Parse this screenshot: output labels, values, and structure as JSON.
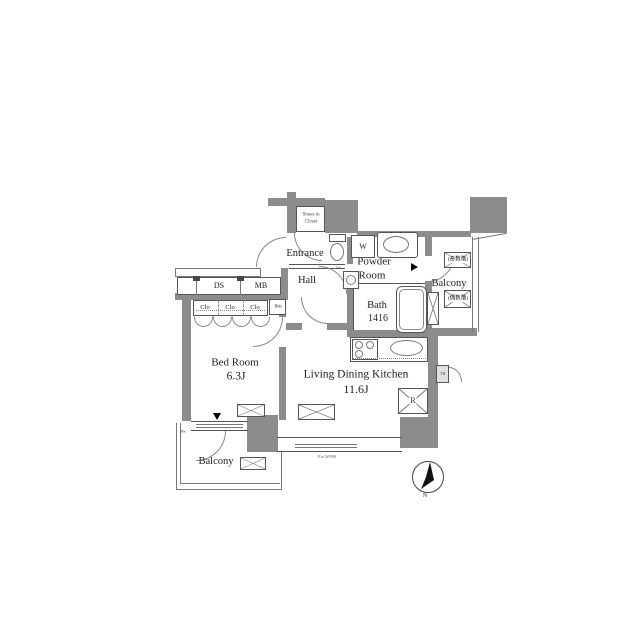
{
  "rooms": {
    "bedroom": {
      "name": "Bed Room",
      "size": "6.3J"
    },
    "ldk": {
      "name": "Living Dining Kitchen",
      "size": "11.6J"
    },
    "entrance": {
      "name": "Entrance"
    },
    "hall": {
      "name": "Hall"
    },
    "powder": {
      "line1": "Powder",
      "line2": "Room"
    },
    "bath": {
      "name": "Bath",
      "size": "1416"
    },
    "balcony_left": {
      "name": "Balcony"
    },
    "balcony_right": {
      "name": "Balcony"
    },
    "shoes_closet": {
      "line1": "Shoes in",
      "line2": "Closet"
    }
  },
  "labels": {
    "ds": "DS",
    "mb": "MB",
    "clo1": "Clo",
    "clo2": "Clo",
    "clo3": "Clo",
    "sto": "Sto",
    "washer": "W",
    "fridge": "R",
    "ps": "PS",
    "hatch_odd": "(奇数階)",
    "hatch_even": "(偶数階)",
    "fix_window": "Fix W990",
    "basin": "1m",
    "trunk": "TR",
    "compass_north": "N"
  },
  "colors": {
    "wall": "#8c8c8c",
    "line": "#555555",
    "text": "#222222",
    "background": "#ffffff"
  }
}
